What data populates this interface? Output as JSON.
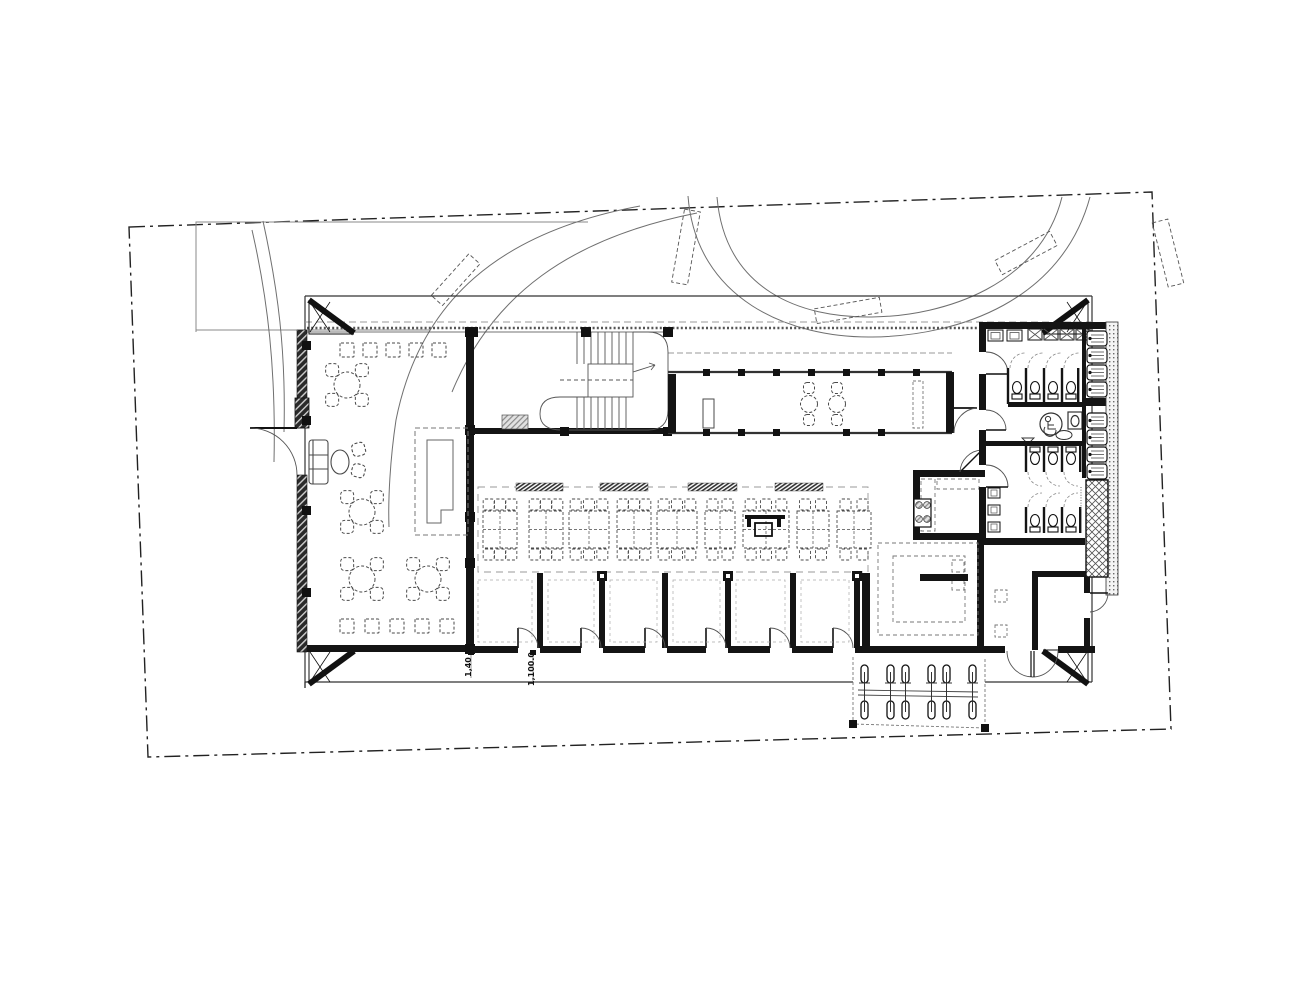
{
  "drawing": {
    "type": "architectural-floor-plan",
    "colors": {
      "ink": "#111111",
      "wall": "#141414",
      "mid": "#4a4a4a",
      "thin": "#666666",
      "faint": "#999999",
      "bg": "#ffffff"
    }
  },
  "annotations": {
    "dim_a": "1,40",
    "dim_b": "1,100.0"
  },
  "furniture": {
    "cafe_stools_top": {
      "y": 343,
      "size": 14,
      "xs": [
        340,
        363,
        386,
        409,
        432
      ]
    },
    "cafe_stools_bottom": {
      "y": 619,
      "size": 14,
      "xs": [
        340,
        365,
        390,
        415,
        440
      ]
    },
    "cafe_round_tables": [
      [
        347,
        385
      ],
      [
        362,
        512
      ],
      [
        362,
        579
      ],
      [
        428,
        579
      ]
    ],
    "corridor_tables": [
      [
        809,
        404
      ],
      [
        837,
        404
      ]
    ],
    "dining_groups": [
      {
        "x": 483,
        "w": 34,
        "seats": 3,
        "station": false
      },
      {
        "x": 529,
        "w": 34,
        "seats": 3,
        "station": false
      },
      {
        "x": 569,
        "w": 40,
        "seats": 3,
        "station": false
      },
      {
        "x": 617,
        "w": 34,
        "seats": 3,
        "station": false
      },
      {
        "x": 657,
        "w": 40,
        "seats": 3,
        "station": false
      },
      {
        "x": 705,
        "w": 30,
        "seats": 2,
        "station": false
      },
      {
        "x": 743,
        "w": 46,
        "seats": 3,
        "station": true
      },
      {
        "x": 797,
        "w": 32,
        "seats": 2,
        "station": false
      },
      {
        "x": 837,
        "w": 34,
        "seats": 2,
        "station": false
      }
    ],
    "dining_label_bars": [
      [
        516,
        47
      ],
      [
        600,
        48
      ],
      [
        688,
        49
      ],
      [
        775,
        48
      ]
    ],
    "bay_partitions": [
      540,
      602,
      665,
      728,
      793,
      857
    ],
    "bay_caps": [
      602,
      728,
      857
    ],
    "bay_doors": [
      518,
      581,
      645,
      706,
      770,
      833
    ],
    "mens_partitions": [
      1008,
      1026,
      1044,
      1062
    ],
    "mens_toilets": [
      1017,
      1035,
      1053,
      1071
    ],
    "womens_partitions": [
      1026,
      1044,
      1062
    ],
    "womens_toilets": [
      1035,
      1053,
      1071
    ],
    "basins_x": [
      1028,
      1044,
      1060,
      1076
    ],
    "rect_sinks_x": [
      988,
      1007
    ],
    "womens_side_sinks_y": [
      488,
      505,
      522
    ],
    "urinals_y1": [
      331,
      348,
      365,
      382
    ],
    "urinals_y2": [
      413,
      430,
      447,
      464
    ],
    "bikes_x": [
      861,
      887,
      902,
      928,
      943,
      969
    ]
  }
}
